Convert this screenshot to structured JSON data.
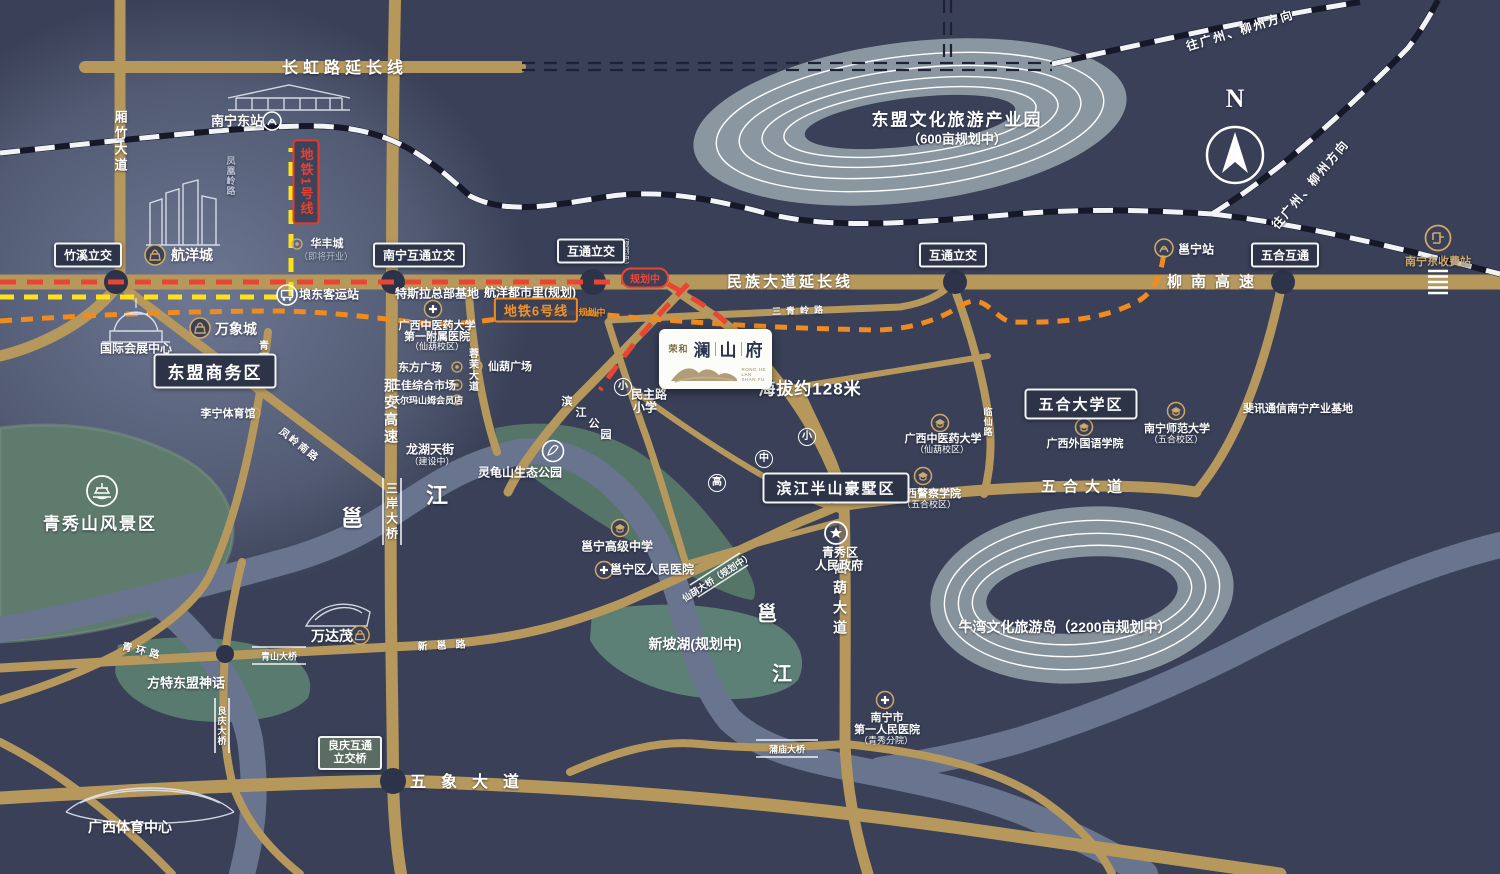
{
  "roads": {
    "changhong": "长虹路延长线",
    "xiangzhu": "厢竹大道",
    "fenghuangling": "凤凰岭路",
    "minzu": "民族大道延长线",
    "liunan": "柳南高速",
    "naan": "那安高速",
    "sanan_bridge": "三岸大桥",
    "yong": "邕",
    "jiang": "江",
    "qinghuan": "青环路",
    "fenglingnan": "凤岭南路",
    "rongmo": "蓉茉大道",
    "wuhe_ave": "五合大道",
    "wuxiang_ave": "五象大道",
    "xianhu_ave": "仙葫大道",
    "qingshan_bridge": "青山大桥",
    "liangqing_bridge": "良庆大桥",
    "xinyong": "新邕路",
    "pumiao_bridge": "蒲庙大桥",
    "linxian": "临仙路",
    "sanqingling": "三青岭路",
    "xianhu_bridge": "仙葫大桥（规划中）",
    "binjiang_park": [
      "滨",
      "江",
      "公",
      "园"
    ]
  },
  "transit": {
    "metro1": "地铁1号线",
    "metro6": "地铁6号线",
    "planning": "规划中",
    "planning_paren": "（规划中）",
    "railway_dir": "往广州、柳州方向",
    "nanning_east_station": "南宁东站",
    "yongning_station": "邕宁站",
    "langdong_bus": "埌东客运站",
    "toll_station": "南宁东收费站"
  },
  "badges": {
    "zhuxi": "竹溪立交",
    "nn_hutong": "南宁互通立交",
    "hutong": "互通立交",
    "wuhe_hutong": "五合互通",
    "liangqing_l1": "良庆互通",
    "liangqing_l2": "立交桥"
  },
  "boxes": {
    "dongmeng_biz": "东盟商务区",
    "wuhe_univ": "五合大学区",
    "binjiang_villa": "滨江半山豪墅区"
  },
  "areas": {
    "dongmeng_park": "东盟文化旅游产业园",
    "dongmeng_park_sub": "（600亩规划中）",
    "niuwan": "牛湾文化旅游岛（2200亩规划中）",
    "xinpohu": "新坡湖(规划中)",
    "qingxiushan": "青秀山风景区",
    "fangte": "方特东盟神话",
    "elevation": "海拔约128米"
  },
  "places": {
    "hangyang": "航洋城",
    "huafeng": "华丰城",
    "huafeng_sub": "（即将开业）",
    "wanxiang": "万象城",
    "intl_center": "国际会展中心",
    "tesla": "特斯拉总部基地",
    "hangyang_dushi": "航洋都市里(规划)",
    "tcm_hosp_l1": "广西中医药大学",
    "tcm_hosp_l2": "第一附属医院",
    "campus_xianhu": "（仙葫校区）",
    "campus_wuhe": "（五合校区）",
    "dongfang": "东方广场",
    "zhengjia": "正佳综合市场",
    "walmart": "沃尔玛山姆会员店",
    "xianhu_plaza": "仙葫广场",
    "lining": "李宁体育馆",
    "longhu": "龙湖天街",
    "longhu_sub": "（建设中）",
    "linggui": "灵龟山生态公园",
    "minzhu_l1": "民主路",
    "minzhu_l2": "小学",
    "tcm_univ": "广西中医药大学",
    "police": "广西警察学院",
    "gov_l1": "青秀区",
    "gov_l2": "人民政府",
    "foreign": "广西外国语学院",
    "normal": "南宁师范大学",
    "feixun": "斐讯通信南宁产业基地",
    "yongning_hs": "邕宁高级中学",
    "yongning_hosp": "邕宁区人民医院",
    "first_hosp_l1": "南宁市",
    "first_hosp_l2": "第一人民医院",
    "first_hosp_l3": "（青秀分院）",
    "wandamao": "万达茂",
    "gx_sports": "广西体育中心"
  },
  "markers": {
    "xiao": "小",
    "zhong": "中",
    "gao": "高"
  },
  "logo": {
    "brand": "荣和",
    "n1": "澜",
    "n2": "山",
    "n3": "府",
    "en1": "RONG HE",
    "en2": "LAN",
    "en3": "SHAN FU"
  },
  "compass": {
    "n": "N"
  }
}
